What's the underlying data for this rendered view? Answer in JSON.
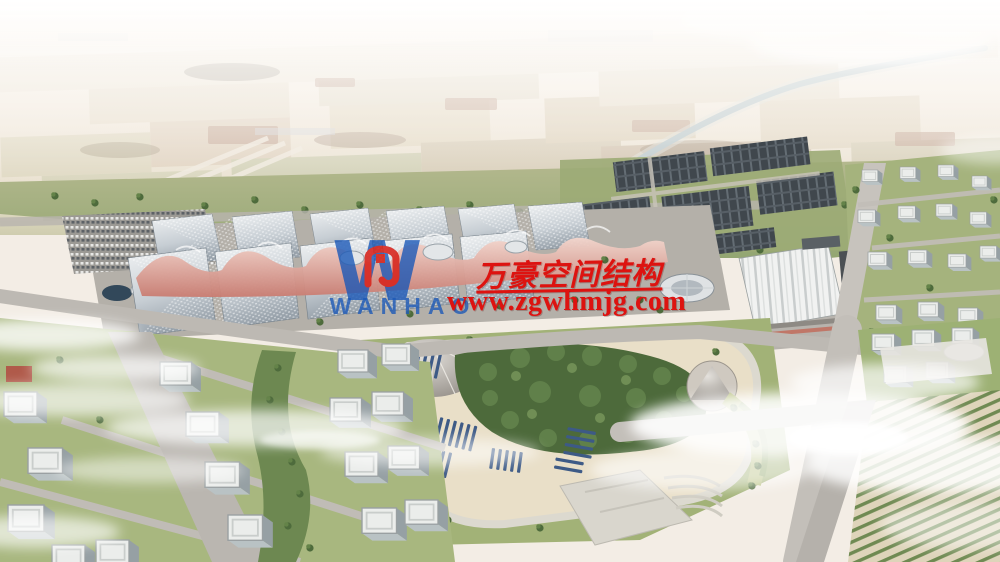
{
  "watermark": {
    "logo_text": "WANHAO",
    "company_name": "万豪空间结构",
    "website": "www.zgwhmjg.com",
    "red": "#dd1310",
    "blue": "#1a58b8"
  },
  "scene_colors": {
    "membrane_pink": "#d98f80",
    "hall_roof_gray": "#c6ccd2",
    "solar_panel_blue": "#3d5a86",
    "grass_green": "#a3b27b",
    "haze_white": "#faf7f2"
  }
}
